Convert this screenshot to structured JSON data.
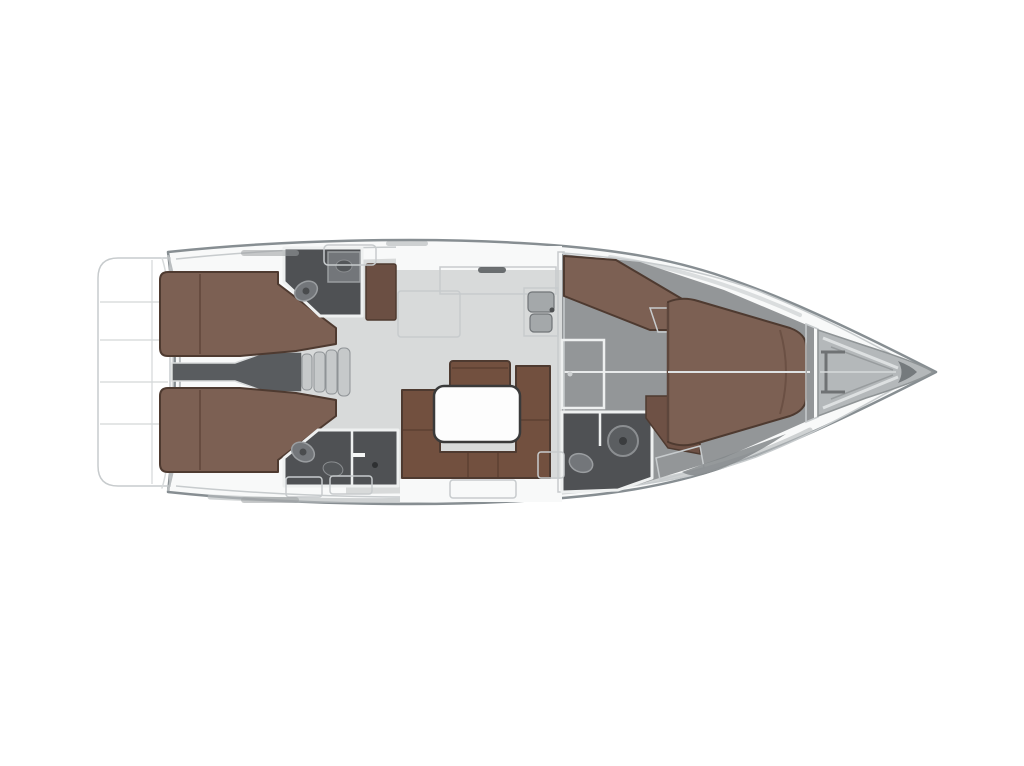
{
  "meta": {
    "type": "yacht-interior-floor-plan",
    "orientation": "bow-right",
    "description": "Top-down interior layout plan of a sailing yacht with three cabins, three heads, salon and galley"
  },
  "colors": {
    "background": "#ffffff",
    "hull_fill": "#f8f9f9",
    "hull_outline": "#878e92",
    "platform_fill": "#f1f2f2",
    "deck_white": "#fbfcfc",
    "salon_floor": "#d8dada",
    "cabin_floor": "#939698",
    "engine_gray": "#595c5f",
    "head_floor": "#4f5154",
    "step_gray": "#c6c9ca",
    "berth_brown": "#7c6053",
    "berth_brown_dark": "#5d463c",
    "wardrobe_brown": "#6b4f43",
    "seat_brown": "#6e5145",
    "sofa_brown": "#72503f",
    "sofa_seam": "#52382c",
    "fixture_gray": "#73767a",
    "fixture_dark": "#54575a",
    "basin_gray": "#a4a8aa",
    "wall_white": "#eef0f0",
    "table_white": "#fdfdfd",
    "table_border": "#3a3a3a",
    "locker_gray": "#b4b8ba",
    "bow_tip": "#757a7d",
    "shade_gray": "#b9bdbf",
    "hatch_gray": "#9b9fa1",
    "wedge_gray": "#84888b"
  },
  "rooms": [
    {
      "id": "swim-platform",
      "label": "Swim platform"
    },
    {
      "id": "aft-cabin-starboard",
      "label": "Aft double cabin, starboard"
    },
    {
      "id": "aft-cabin-port",
      "label": "Aft double cabin, port"
    },
    {
      "id": "aft-head-starboard",
      "label": "Aft head, starboard"
    },
    {
      "id": "aft-head-port",
      "label": "Aft head with shower, port"
    },
    {
      "id": "engine-companionway",
      "label": "Engine space and companionway steps"
    },
    {
      "id": "galley",
      "label": "Galley with double sink"
    },
    {
      "id": "salon",
      "label": "Salon with U-settee and table"
    },
    {
      "id": "forward-cabin",
      "label": "Owner forward cabin"
    },
    {
      "id": "forward-head",
      "label": "Forward en-suite head"
    },
    {
      "id": "anchor-locker",
      "label": "Bow anchor locker"
    }
  ]
}
